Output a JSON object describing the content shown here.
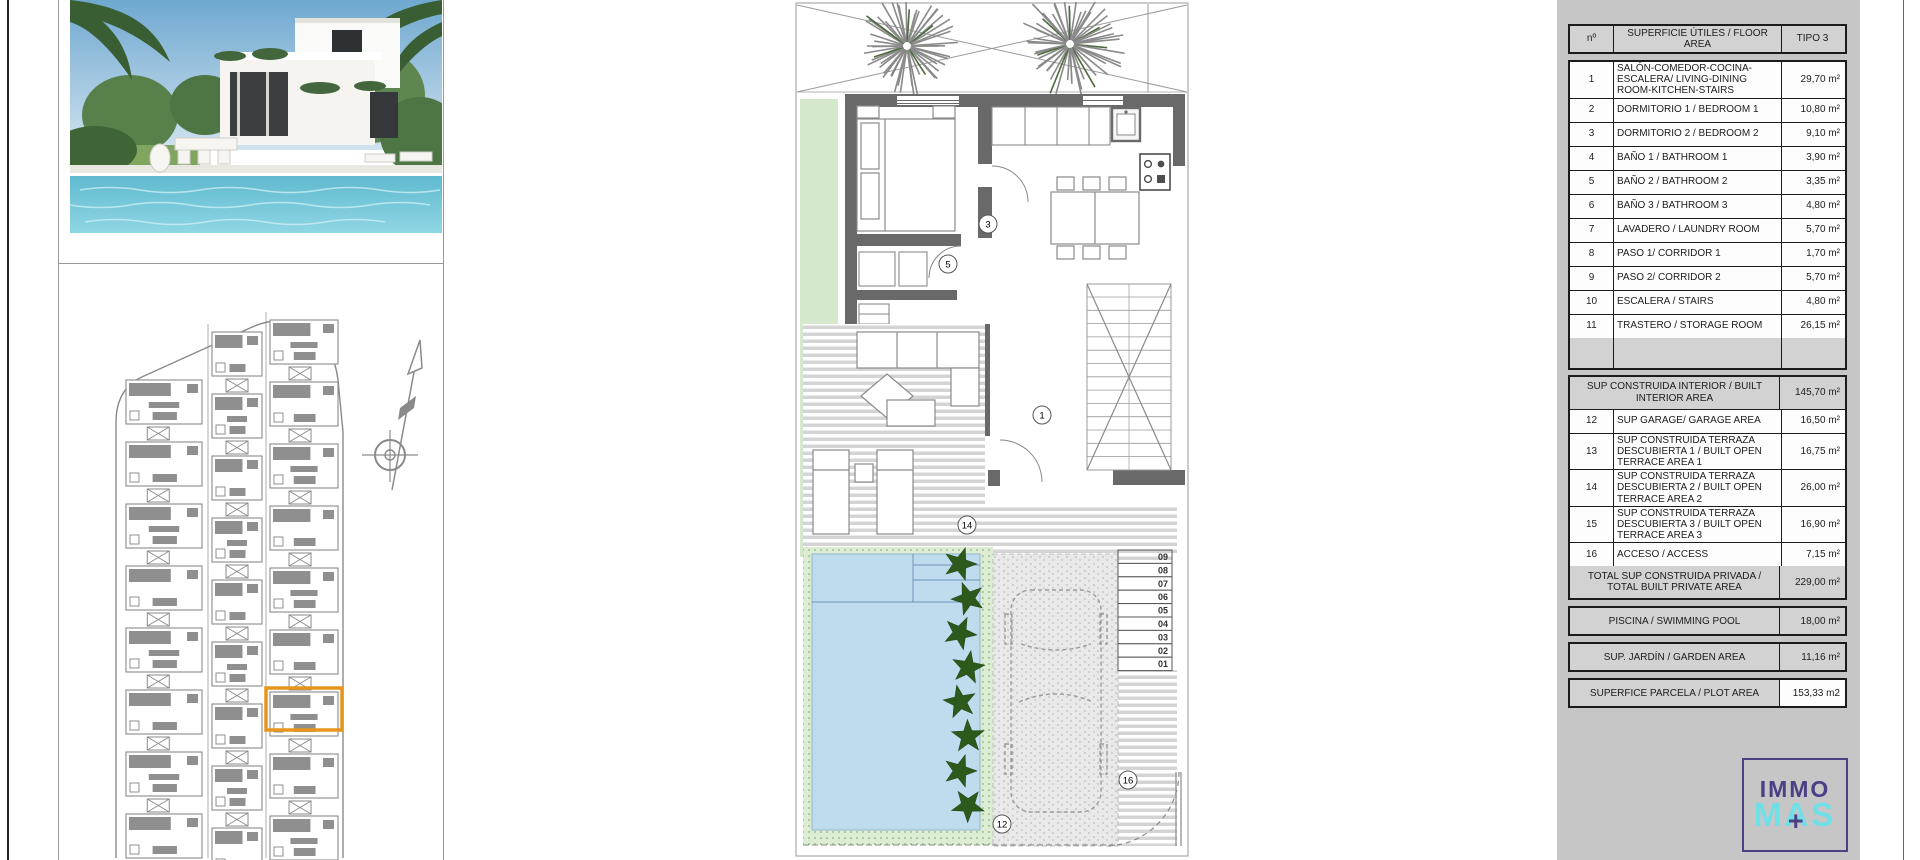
{
  "area_table": {
    "header": {
      "num_label": "nº",
      "area_label": "SUPERFICIE ÚTILES / FLOOR AREA",
      "type_label": "TIPO 3"
    },
    "rows": [
      {
        "num": "1",
        "label": "SALÓN-COMEDOR-COCINA-ESCALERA/ LIVING-DINING ROOM-KITCHEN-STAIRS",
        "value": "29,70 m²"
      },
      {
        "num": "2",
        "label": "DORMITORIO 1 / BEDROOM 1",
        "value": "10,80 m²"
      },
      {
        "num": "3",
        "label": "DORMITORIO 2 / BEDROOM 2",
        "value": "9,10 m²"
      },
      {
        "num": "4",
        "label": "BAÑO 1 / BATHROOM 1",
        "value": "3,90 m²"
      },
      {
        "num": "5",
        "label": "BAÑO 2 / BATHROOM 2",
        "value": "3,35 m²"
      },
      {
        "num": "6",
        "label": "BAÑO 3 / BATHROOM 3",
        "value": "4,80 m²"
      },
      {
        "num": "7",
        "label": "LAVADERO / LAUNDRY ROOM",
        "value": "5,70 m²"
      },
      {
        "num": "8",
        "label": "PASO 1/ CORRIDOR 1",
        "value": "1,70 m²"
      },
      {
        "num": "9",
        "label": "PASO 2/ CORRIDOR 2",
        "value": "5,70 m²"
      },
      {
        "num": "10",
        "label": "ESCALERA / STAIRS",
        "value": "4,80 m²"
      },
      {
        "num": "11",
        "label": "TRASTERO / STORAGE ROOM",
        "value": "26,15 m²"
      },
      {
        "num": "12",
        "label": "SUP GARAGE/ GARAGE AREA",
        "value": "16,50 m²"
      },
      {
        "num": "13",
        "label": "SUP CONSTRUIDA TERRAZA DESCUBIERTA 1 / BUILT OPEN TERRACE AREA 1",
        "value": "16,75 m²"
      },
      {
        "num": "14",
        "label": "SUP CONSTRUIDA TERRAZA DESCUBIERTA 2 / BUILT OPEN TERRACE AREA 2",
        "value": "26,00 m²"
      },
      {
        "num": "15",
        "label": "SUP CONSTRUIDA TERRAZA DESCUBIERTA 3 / BUILT OPEN TERRACE AREA 3",
        "value": "16,90 m²"
      },
      {
        "num": "16",
        "label": "ACCESO / ACCESS",
        "value": "7,15 m²"
      }
    ],
    "summaries": {
      "interior": {
        "label": "SUP CONSTRUIDA INTERIOR / BUILT INTERIOR AREA",
        "value": "145,70 m²"
      },
      "total": {
        "label": "TOTAL SUP CONSTRUIDA PRIVADA / TOTAL BUILT PRIVATE AREA",
        "value": "229,00 m²"
      },
      "pool": {
        "label": "PISCINA / SWIMMING POOL",
        "value": "18,00 m²"
      },
      "garden": {
        "label": "SUP. JARDÍN / GARDEN AREA",
        "value": "11,16 m²"
      },
      "plot": {
        "label": "SUPERFICE PARCELA / PLOT AREA",
        "value": "153,33 m2"
      }
    }
  },
  "floor_plan": {
    "callouts": {
      "living": "1",
      "bedroom_door": "3",
      "corridor_door": "5",
      "terrace": "14",
      "pool_side": "12",
      "access": "16"
    },
    "steps": [
      "09",
      "08",
      "07",
      "06",
      "05",
      "04",
      "03",
      "02",
      "01"
    ]
  },
  "logo": {
    "top": "IMMO",
    "bottom": "MAS",
    "plus": "+"
  },
  "colors": {
    "highlight_orange": "#E8951D",
    "pool_blue": "#BFDCEE",
    "garden_green": "#D4E8CC",
    "hedge_green": "#2C5A1D",
    "wall_gray": "#696969",
    "plan_gray": "#8A8A8A",
    "panel_gray": "#C6C6C6",
    "logo_purple": "#4A4084",
    "logo_cyan": "#6FDFE8"
  }
}
